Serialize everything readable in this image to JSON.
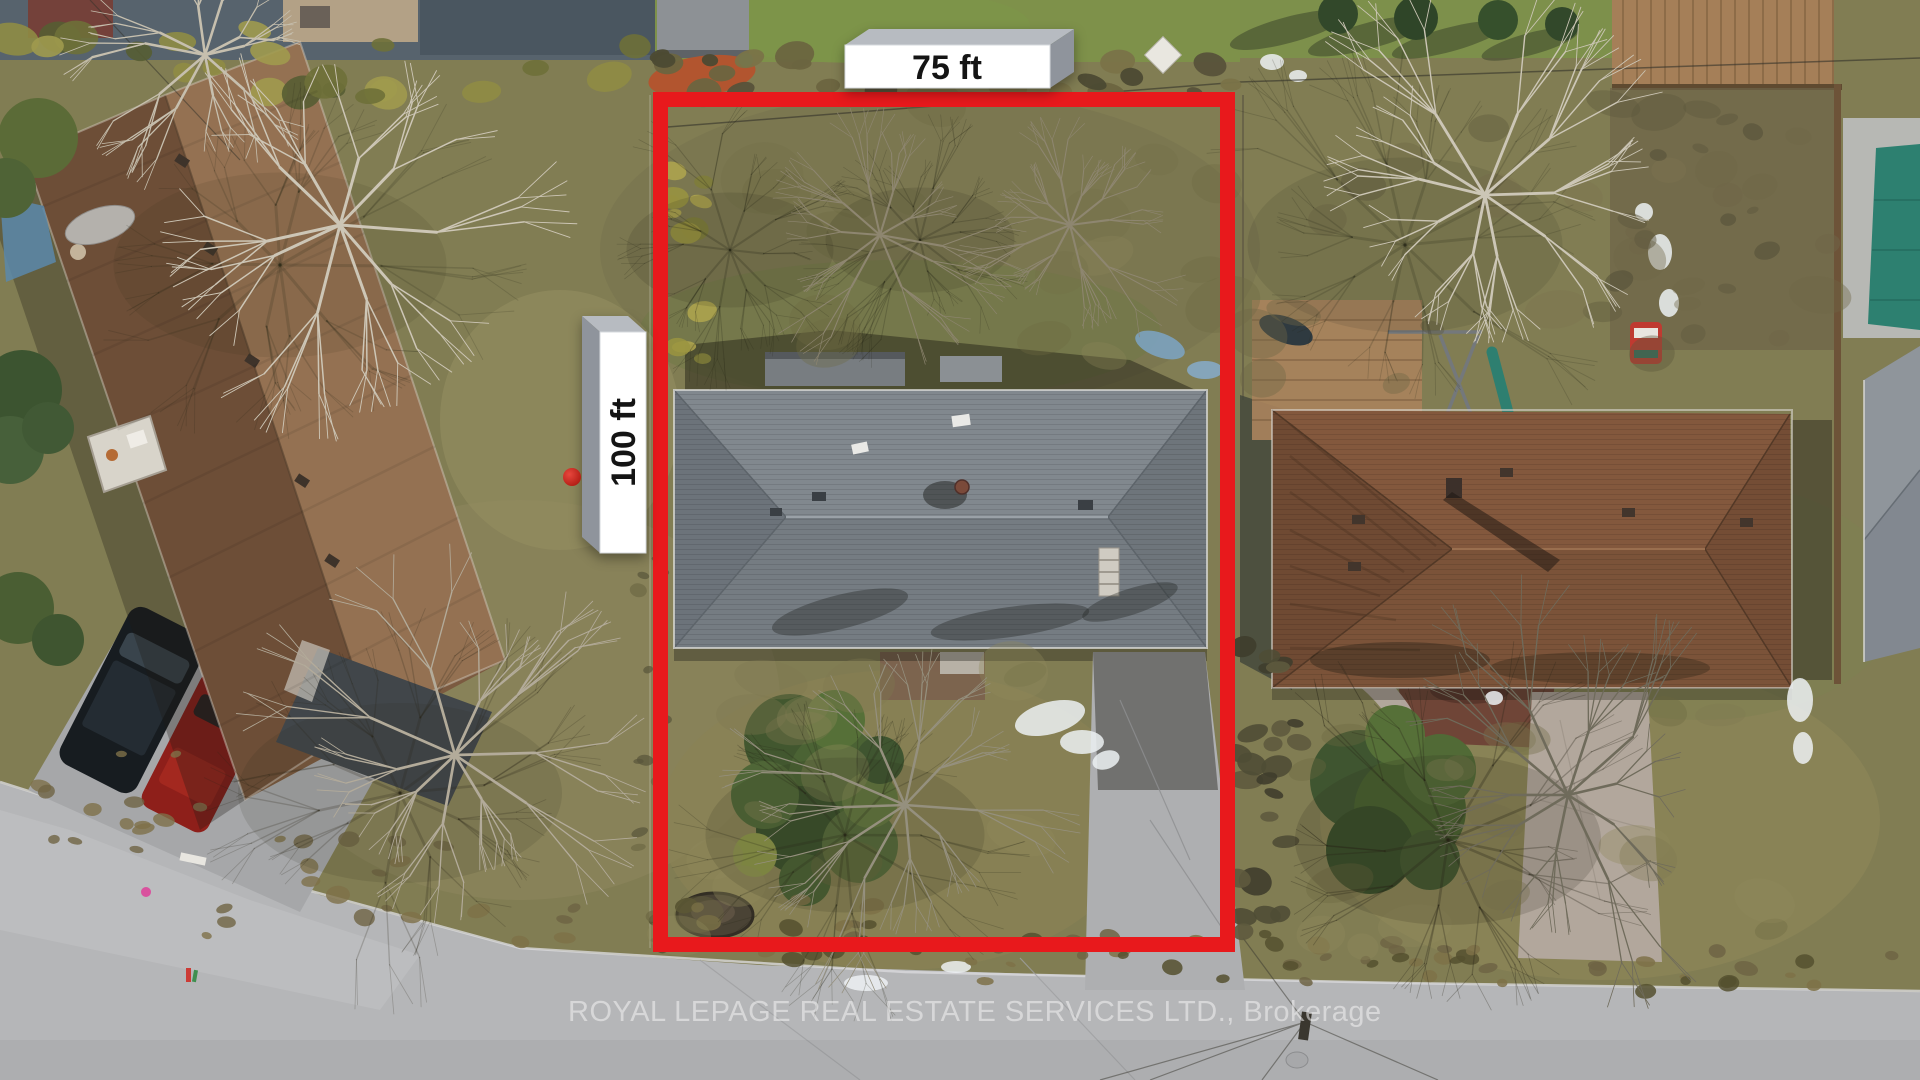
{
  "annotations": {
    "width_label": "75 ft",
    "depth_label": "100 ft",
    "boundary_color": "#e8191c",
    "label_face_color": "#ffffff",
    "label_bevel_top_color": "#b7bbc1",
    "label_bevel_side_color": "#8f949c",
    "label_text_color": "#141414"
  },
  "watermark": {
    "text": "ROYAL LEPAGE REAL ESTATE SERVICES LTD., Brokerage",
    "color": "#f3f3f3"
  },
  "scene_colors": {
    "grass": "#817d53",
    "road": "#b5b6b8",
    "subject_roof_gray": "#7b8288",
    "left_neighbor_roof_brown": "#7d5c40",
    "right_neighbor_roof_brown": "#7e553a",
    "pool_cover_teal": "#2d8070"
  }
}
